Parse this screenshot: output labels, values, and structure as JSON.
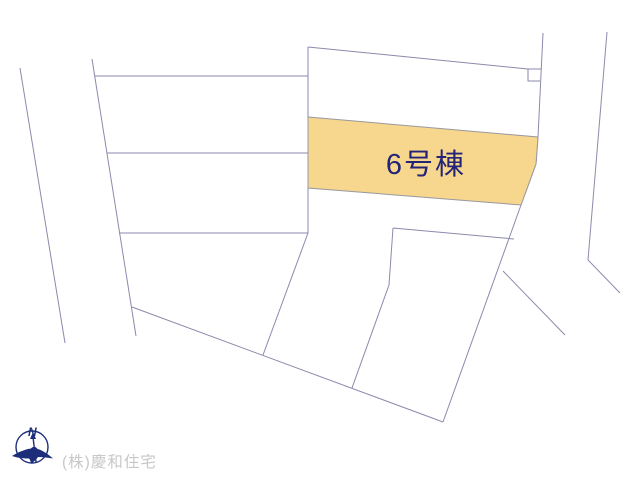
{
  "site_plan": {
    "highlighted_parcel": {
      "label": "6号棟"
    }
  },
  "compass": {
    "north_label": "N"
  },
  "watermark": {
    "company": "(株)慶和住宅"
  },
  "colors": {
    "background": "#ffffff",
    "line_color": "#8a8aac",
    "highlight_fill": "#f7d78e",
    "highlight_border": "#98989f",
    "label_color": "#232377",
    "compass_color": "#1c2d7a",
    "watermark_color": "#c8c8c8"
  }
}
